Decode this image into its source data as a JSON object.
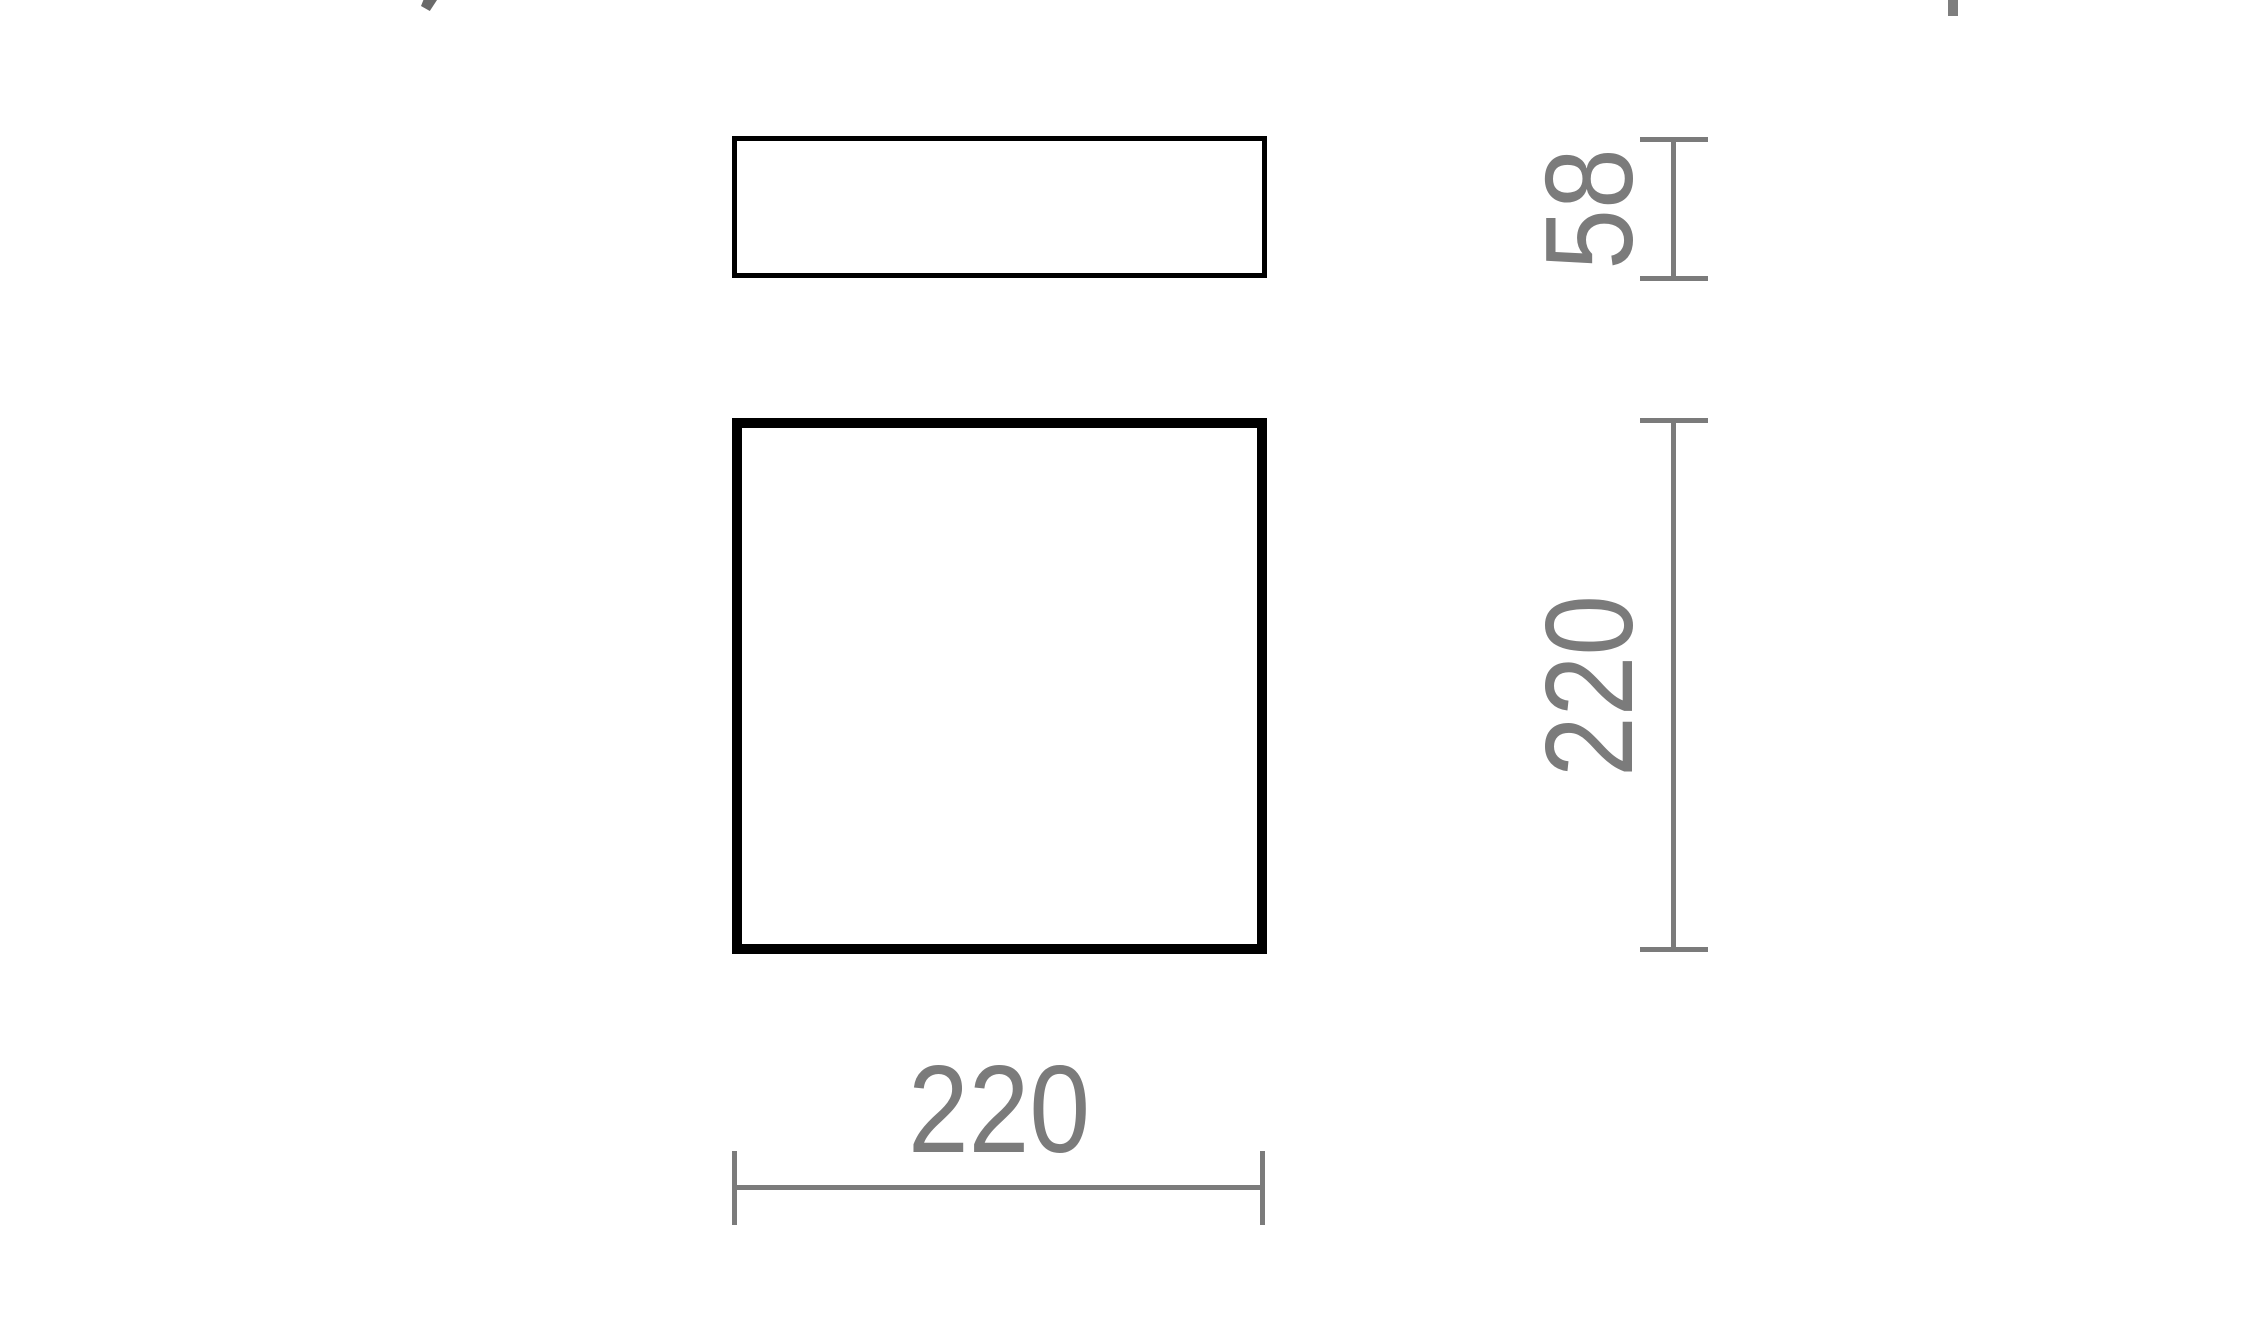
{
  "drawing": {
    "type": "technical-dimension-drawing",
    "colors": {
      "outline": "#000000",
      "dimension": "#7b7b7b",
      "background": "#ffffff"
    },
    "views": {
      "side_view": {
        "shape": "rectangle",
        "width_label": "220",
        "height_label": "58"
      },
      "front_view": {
        "shape": "square",
        "width_label": "220",
        "height_label": "220"
      }
    },
    "dimensions": {
      "side_height": {
        "label": "58"
      },
      "front_height": {
        "label": "220"
      },
      "front_width": {
        "label": "220"
      }
    },
    "fragments": {
      "top_left": "cropped-glyph-fragment",
      "top_right": "cropped-bar-fragment"
    }
  }
}
